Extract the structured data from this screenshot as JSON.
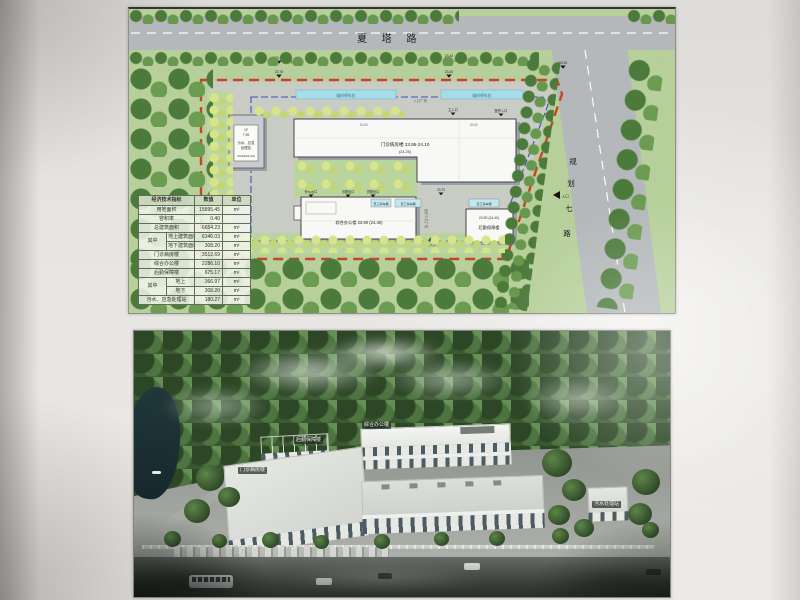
{
  "site_plan": {
    "road_top_label": "夏 塔 路",
    "road_right_chars": [
      "规",
      "划",
      "七",
      "路"
    ],
    "entrance_arrow_label": "入口",
    "plaza_label": "入口广场",
    "staff_plaza_label": "医护人员广场",
    "temp_parking_label": "临时停车位",
    "sheds": [
      "员工停车棚",
      "员工停车棚",
      "员工停车棚"
    ],
    "markers": [
      {
        "value": "23.14",
        "label": "污物出口"
      },
      {
        "value": "23.76",
        "label": ""
      },
      {
        "value": "23.44",
        "label": "主要出入口"
      },
      {
        "value": "23.40",
        "label": ""
      },
      {
        "value": "23.32",
        "label": ""
      },
      {
        "value": "23.70",
        "label": ""
      },
      {
        "value": "",
        "label": "停车出口"
      },
      {
        "value": "",
        "label": "污物出口"
      },
      {
        "value": "",
        "label": "货物出口"
      },
      {
        "value": "",
        "label": "次入口"
      },
      {
        "value": "",
        "label": "主入口"
      },
      {
        "value": "",
        "label": "医护入口"
      }
    ],
    "buildings": {
      "outpatient": {
        "name_elev": "门诊病房楼  23.95-24.10",
        "elev2": "(24.25)",
        "dim": "84.80"
      },
      "office": {
        "name_elev": "综合办公楼 23.90 (24.40)"
      },
      "logistics": {
        "name": "后勤保障楼",
        "elev": "23.90 (24.40)"
      },
      "sewage": {
        "line1": "1F",
        "line2": "7.95",
        "line3": "污水、应急",
        "line4": "处理站",
        "line5": "23.90(24.20)"
      }
    },
    "boundary_colors": {
      "red_line": "#c9371f",
      "blue_line": "#3a52c2"
    }
  },
  "table": {
    "header": {
      "c1": "经济技术指标",
      "c2": "数值",
      "c3": "单位"
    },
    "group1": "其中",
    "group2": "其中",
    "rows": [
      {
        "label": "用地面积",
        "value": "15895.45",
        "unit": "m²"
      },
      {
        "label": "容积率",
        "value": "0.40",
        "unit": ""
      },
      {
        "label": "总建筑面积",
        "value": "6654.23",
        "unit": "m²"
      },
      {
        "label": "地上建筑面积",
        "value": "6346.03",
        "unit": "m²"
      },
      {
        "label": "地下建筑面积",
        "value": "308.20",
        "unit": "m²"
      },
      {
        "label": "门诊病房楼",
        "value": "3512.69",
        "unit": "m²"
      },
      {
        "label": "综合办公楼",
        "value": "2286.10",
        "unit": "m²"
      },
      {
        "label": "后勤保障楼",
        "value": "675.17",
        "unit": "m²"
      },
      {
        "label": "地上",
        "value": "366.97",
        "unit": "m²"
      },
      {
        "label": "地下",
        "value": "308.20",
        "unit": "m²"
      },
      {
        "label": "污水、应急处理站",
        "value": "180.27",
        "unit": "m²"
      }
    ]
  },
  "rendering": {
    "labels": {
      "office": "综合办公楼",
      "logistics": "后勤保障楼",
      "clinic": "门诊病房楼",
      "sewage": "污水处理站"
    }
  }
}
